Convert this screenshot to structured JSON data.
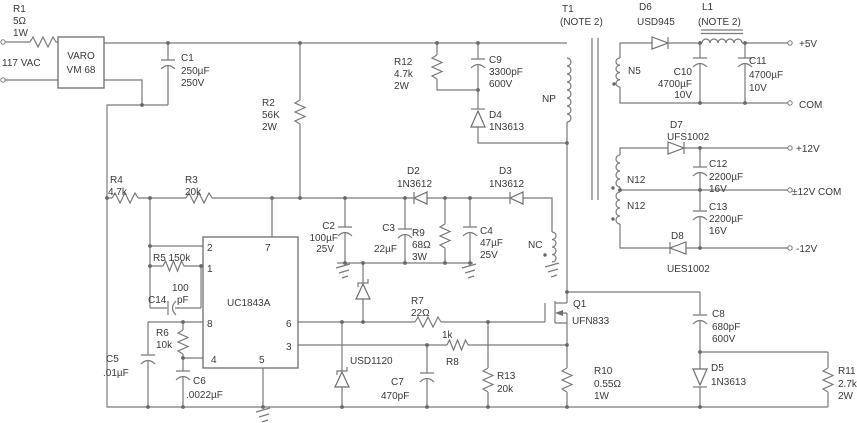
{
  "palette": {
    "background": "#ffffff",
    "wire": "#7a7a7a",
    "ink": "#3a3a3a"
  },
  "input": {
    "r1": {
      "ref": "R1",
      "value": "5Ω",
      "power": "1W"
    },
    "source": "117 VAC",
    "bridge": {
      "brand": "VARO",
      "model": "VM 68"
    },
    "c1": {
      "ref": "C1",
      "value": "250µF",
      "rating": "250V"
    },
    "r2": {
      "ref": "R2",
      "value": "56K",
      "power": "2W"
    }
  },
  "snubber": {
    "r12": {
      "ref": "R12",
      "value": "4.7k",
      "power": "2W"
    },
    "c9": {
      "ref": "C9",
      "value": "3300pF",
      "rating": "600V"
    },
    "d4": {
      "ref": "D4",
      "part": "1N3613"
    }
  },
  "transformer": {
    "ref": "T1",
    "note": "(NOTE 2)",
    "primary": "NP",
    "control": "NC",
    "sec5": "N5",
    "sec12_top": "N12",
    "sec12_bottom": "N12"
  },
  "out5": {
    "d6": {
      "ref": "D6",
      "part": "USD945"
    },
    "l1": {
      "ref": "L1",
      "note": "(NOTE 2)"
    },
    "c10": {
      "ref": "C10",
      "value": "4700µF",
      "rating": "10V"
    },
    "c11": {
      "ref": "C11",
      "value": "4700µF",
      "rating": "10V"
    },
    "plus5": "+5V",
    "com": "COM"
  },
  "out12": {
    "d7": {
      "ref": "D7",
      "part": "UFS1002"
    },
    "d8": {
      "ref": "D8",
      "part": "UES1002"
    },
    "c12": {
      "ref": "C12",
      "value": "2200µF",
      "rating": "16V"
    },
    "c13": {
      "ref": "C13",
      "value": "2200µF",
      "rating": "16V"
    },
    "plus12": "+12V",
    "com": "±12V COM",
    "minus12": "-12V"
  },
  "controller": {
    "part": "UC1843A",
    "pins": {
      "p1": "1",
      "p2": "2",
      "p3": "3",
      "p4": "4",
      "p5": "5",
      "p6": "6",
      "p7": "7",
      "p8": "8"
    }
  },
  "feedback": {
    "r4": {
      "ref": "R4",
      "value": "4.7k"
    },
    "r3": {
      "ref": "R3",
      "value": "20k"
    },
    "r5": "R5 150k",
    "c14": {
      "value": "100",
      "unit": "pF",
      "ref": "C14"
    },
    "r6": {
      "ref": "R6",
      "value": "10k"
    },
    "c5": {
      "ref": "C5",
      "value": ".01µF"
    },
    "c6": {
      "ref": "C6",
      "value": ".0022µF"
    }
  },
  "vcc": {
    "c2": {
      "ref": "C2",
      "value": "100µF",
      "rating": "25V"
    },
    "c3": {
      "ref": "C3",
      "value": "22µF"
    },
    "r9": {
      "ref": "R9",
      "value": "68Ω",
      "power": "3W"
    },
    "c4": {
      "ref": "C4",
      "value": "47µF",
      "rating": "25V"
    },
    "d2": {
      "ref": "D2",
      "part": "1N3612"
    },
    "d3": {
      "ref": "D3",
      "part": "1N3612"
    }
  },
  "gate": {
    "r7": {
      "ref": "R7",
      "value": "22Ω"
    },
    "r8": {
      "value": "1k",
      "ref": "R8"
    },
    "clamp": "USD1120",
    "c7": {
      "ref": "C7",
      "value": "470pF"
    },
    "r13": {
      "ref": "R13",
      "value": "20k"
    }
  },
  "power": {
    "q1": {
      "ref": "Q1",
      "part": "UFN833"
    },
    "r10": {
      "ref": "R10",
      "value": "0.55Ω",
      "power": "1W"
    },
    "c8": {
      "ref": "C8",
      "value": "680pF",
      "rating": "600V"
    },
    "d5": {
      "ref": "D5",
      "part": "1N3613"
    },
    "r11": {
      "ref": "R11",
      "value": "2.7k",
      "power": "2W"
    }
  }
}
